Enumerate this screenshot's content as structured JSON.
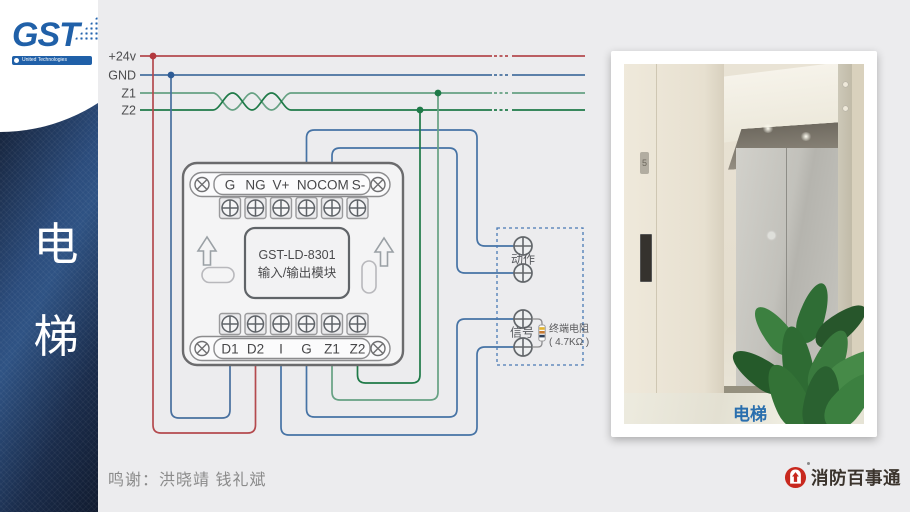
{
  "sidebar": {
    "logo": {
      "text": "GST",
      "tagline": "United Technologies"
    },
    "vertical_title": {
      "char1": "电",
      "char2": "梯"
    }
  },
  "diagram": {
    "bus": {
      "labels": [
        "+24v",
        "GND",
        "Z1",
        "Z2"
      ]
    },
    "module": {
      "title_line1": "GST-LD-8301",
      "title_line2": "输入/输出模块",
      "top_terminals": [
        "G",
        "NG",
        "V+",
        "NO",
        "COM",
        "S-"
      ],
      "bottom_terminals": [
        "D1",
        "D2",
        "I",
        "G",
        "Z1",
        "Z2"
      ]
    },
    "external": {
      "action_label": "动作",
      "signal_label": "信号",
      "resistor_name": "终端电阻",
      "resistor_value": "( 4.7KΩ )"
    },
    "colors": {
      "power": "#b44a4e",
      "ground": "#48709f",
      "z1": "#66a183",
      "z2": "#1f7a48",
      "wire": "#4673a5"
    }
  },
  "photo": {
    "caption": "电梯",
    "floor_sign": "5"
  },
  "footer": {
    "credits": "鸣谢：洪晓靖 钱礼斌",
    "brand": "消防百事通"
  }
}
